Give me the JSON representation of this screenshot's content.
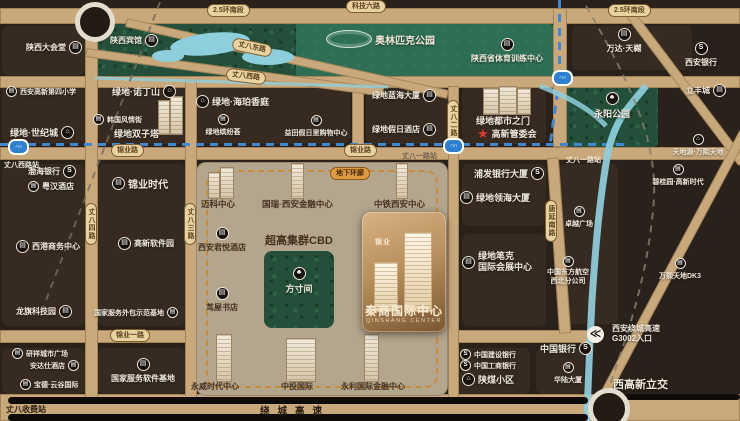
{
  "title": "秦商国际中心区位图",
  "icons": {
    "metro": "∩∩",
    "bank": "S",
    "building": "▤",
    "house": "⌂",
    "tree": "♣",
    "toll": "≪",
    "star": "★"
  },
  "colors": {
    "road": "#c9a87c",
    "block": "#372b21",
    "metro_line": "#3f87d2",
    "park": "#24503b",
    "water": "#8ecfdd",
    "cbd": "#b4a58d",
    "accent_orange": "#e09b3f",
    "star_red": "#e03a2f"
  },
  "roads": {
    "ring25": "2.5环南段",
    "keji6": "科技六路",
    "zb_east": "丈八东路",
    "zb_west": "丈八西路",
    "jinye": "锦业路",
    "jinye1": "锦业一路",
    "raocheng": "绕城高速",
    "zb_toll": "丈八收费站",
    "zb4": "丈八四路",
    "zb3": "丈八三路",
    "zb2": "丈八二路",
    "tangyan": "唐延南路",
    "underpass": "地下环廊",
    "g3002_l1": "西安绕城高速",
    "g3002_l2": "G3002入口",
    "lijiao": "西高新立交"
  },
  "stations": {
    "zbx": "丈八西路站",
    "zb1": "丈八一路站"
  },
  "labels": {
    "shaanxi_hall": "陕西大会堂",
    "shaanxi_hotel": "陕西宾馆",
    "olympic": "奥林匹克公园",
    "sport_center": "陕西省体育训练中心",
    "wanda": "万达·天樾",
    "xian_bank": "西安银行",
    "lifeng": "立丰城",
    "yongyang": "永阳公园",
    "tiandiyuan": "天地源·万熙天地",
    "gx4": "西安高新第四小学",
    "century": "绿地·世纪城",
    "nottinghill": "绿地·诺丁山",
    "korea": "韩国风情街",
    "twins": "绿地双子塔",
    "haipo": "绿地·海珀香庭",
    "binfen": "绿地缤纷荟",
    "yitian": "益田假日里购物中心",
    "lanhai": "绿地蓝海大厦",
    "holiday": "绿地假日酒店",
    "doorcity": "绿地都市之门",
    "admin": "高新管委会",
    "bgy": "碧桂园·高新时代",
    "dk3": "万熙天地DK3",
    "pufa": "浦发银行大厦",
    "linghai": "绿地领海大厦",
    "bike_l1": "绿地笔克",
    "bike_l2": "国际会展中心",
    "zhuoyue": "卓越广场",
    "mu_l1": "中国东方航空",
    "mu_l2": "西北分公司",
    "bohai": "渤海银行",
    "yuehan": "粤汉酒店",
    "xigang": "西港商务中心",
    "longqi": "龙旗科技园",
    "yanxiang": "研祥城市广场",
    "andashi": "安达仕酒店",
    "baode": "宝德·云谷国际",
    "waibao": "国家服务外包示范基地",
    "softbase": "国家服务软件基地",
    "jytime": "锦业时代",
    "gxsoft": "高新软件园",
    "maike": "迈科中心",
    "guorui": "国瑞·西安金融中心",
    "zhongtie": "中铁西安中心",
    "cbd": "超高集群CBD",
    "hyatt": "西安君悦酒店",
    "fangcun": "方寸间",
    "niaowu": "茑屋书店",
    "yongwei": "永威时代中心",
    "zhongtou": "中投国际",
    "yongli": "永利国际金融中心",
    "ccb": "中国建设银行",
    "icbc": "中国工商银行",
    "shanmei": "陕煤小区",
    "boc": "中国银行",
    "hualu": "华陆大厦"
  },
  "project": {
    "logo": "锦业",
    "title": "秦商国际中心",
    "subtitle": "QINSHANG CENTER"
  }
}
